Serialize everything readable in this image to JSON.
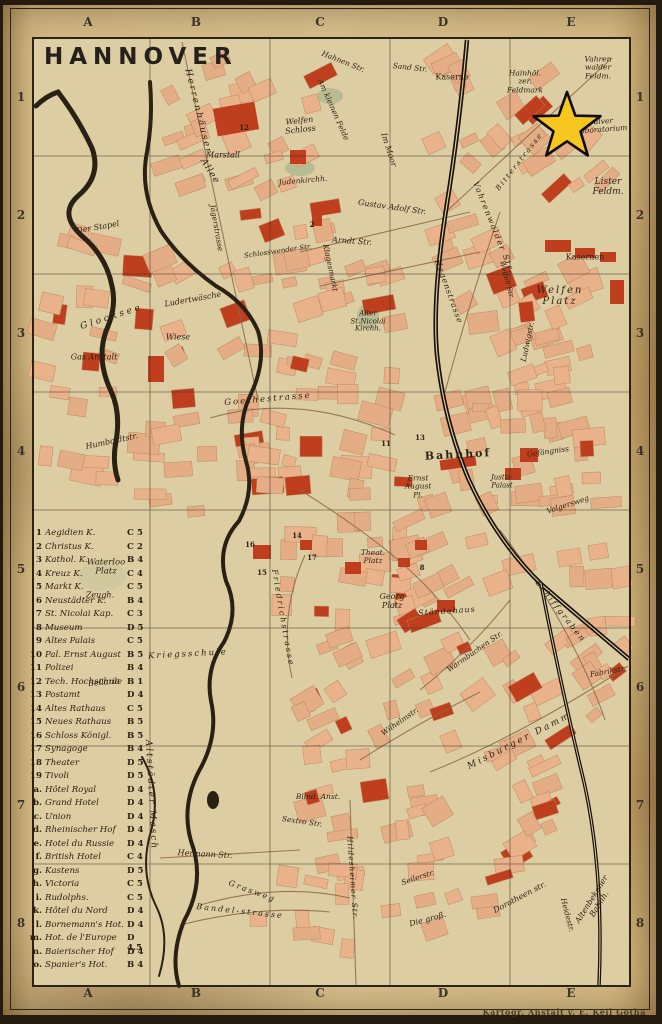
{
  "title": "HANNOVER",
  "attribution": "Kartogr. Anstalt v. E. Keil Gotha",
  "grid": {
    "columns": [
      "A",
      "B",
      "C",
      "D",
      "E"
    ],
    "rows": [
      "1",
      "2",
      "3",
      "4",
      "5",
      "6",
      "7",
      "8"
    ]
  },
  "star": {
    "meaning": "highlight-marker",
    "color": "#f7c71f",
    "near_label": "Pulver Laboratorium"
  },
  "colors": {
    "paper": "#d7bf8d",
    "map_paper": "#ddcda2",
    "block": "#e9b28b",
    "red": "#bf3e1d",
    "ink": "#2e2315",
    "water": "#2a2115",
    "rail": "#16100b",
    "star": "#f7c71f"
  },
  "legend": {
    "entries": [
      {
        "key": "1",
        "label": "Aegidien K.",
        "ref": "C 5"
      },
      {
        "key": "2",
        "label": "Christus K.",
        "ref": "C 2"
      },
      {
        "key": "3",
        "label": "Kathol. K.",
        "ref": "B 4"
      },
      {
        "key": "4",
        "label": "Kreuz K.",
        "ref": "C 4"
      },
      {
        "key": "5",
        "label": "Markt K.",
        "ref": "C 5"
      },
      {
        "key": "6",
        "label": "Neustädter K.",
        "ref": "B 4"
      },
      {
        "key": "7",
        "label": "St. Nicolai Kap.",
        "ref": "C 3"
      },
      {
        "key": "8",
        "label": "Museum",
        "ref": "D 5"
      },
      {
        "key": "9",
        "label": "Altes Palais",
        "ref": "C 5"
      },
      {
        "key": "10",
        "label": "Pal. Ernst August",
        "ref": "B 5"
      },
      {
        "key": "11",
        "label": "Polizei",
        "ref": "B 4"
      },
      {
        "key": "12",
        "label": "Tech. Hochschule",
        "ref": "B 1"
      },
      {
        "key": "13",
        "label": "Postamt",
        "ref": "D 4"
      },
      {
        "key": "14",
        "label": "Altes Rathaus",
        "ref": "C 5"
      },
      {
        "key": "15",
        "label": "Neues Rathaus",
        "ref": "B 5"
      },
      {
        "key": "16",
        "label": "Schloss Königl.",
        "ref": "B 5"
      },
      {
        "key": "17",
        "label": "Synagoge",
        "ref": "B 4"
      },
      {
        "key": "18",
        "label": "Theater",
        "ref": "D 5"
      },
      {
        "key": "19",
        "label": "Tivoli",
        "ref": "D 5"
      },
      {
        "key": "a.",
        "label": "Hôtel Royal",
        "ref": "D 4"
      },
      {
        "key": "b.",
        "label": "Grand Hotel",
        "ref": "D 4"
      },
      {
        "key": "c.",
        "label": "Union",
        "ref": "D 4"
      },
      {
        "key": "d.",
        "label": "Rheinischer Hof",
        "ref": "D 4"
      },
      {
        "key": "e.",
        "label": "Hotel du Russie",
        "ref": "D 4"
      },
      {
        "key": "f.",
        "label": "British Hotel",
        "ref": "C 4"
      },
      {
        "key": "g.",
        "label": "Kastens",
        "ref": "D 5"
      },
      {
        "key": "h.",
        "label": "Victoria",
        "ref": "C 5"
      },
      {
        "key": "i.",
        "label": "Rudolphs.",
        "ref": "C 5"
      },
      {
        "key": "k.",
        "label": "Hôtel du Nord",
        "ref": "D 4"
      },
      {
        "key": "l.",
        "label": "Bornemann's Hot.",
        "ref": "D 4"
      },
      {
        "key": "m.",
        "label": "Hot. de l'Europe",
        "ref": "D 4.5"
      },
      {
        "key": "n.",
        "label": "Baierischer Hof",
        "ref": "D 4"
      },
      {
        "key": "o.",
        "label": "Spanier's Hot.",
        "ref": "B 4"
      }
    ]
  },
  "map_labels": [
    {
      "t": "Herrenhäuser",
      "x": 197,
      "y": 112,
      "r": 76,
      "s": 9,
      "ls": 2
    },
    {
      "t": "Allee",
      "x": 209,
      "y": 172,
      "r": 58,
      "s": 9,
      "ls": 1
    },
    {
      "t": "Jägerstrasse",
      "x": 216,
      "y": 228,
      "r": 80,
      "s": 7.5
    },
    {
      "t": "Welfen\nSchloss",
      "x": 300,
      "y": 126,
      "r": -6,
      "s": 8
    },
    {
      "t": "Marstall",
      "x": 223,
      "y": 156,
      "r": 0,
      "s": 8
    },
    {
      "t": "Judenkirchh.",
      "x": 303,
      "y": 181,
      "r": -5,
      "s": 7.5
    },
    {
      "t": "Im Moor",
      "x": 388,
      "y": 150,
      "r": 72,
      "s": 8
    },
    {
      "t": "Am kleinen Felde",
      "x": 333,
      "y": 110,
      "r": 66,
      "s": 7.5
    },
    {
      "t": "Hahnen Str.",
      "x": 343,
      "y": 62,
      "r": 22,
      "s": 7.5
    },
    {
      "t": "Sand Str.",
      "x": 410,
      "y": 68,
      "r": 6,
      "s": 7.5
    },
    {
      "t": "Kaserne",
      "x": 452,
      "y": 78,
      "r": 0,
      "s": 8,
      "c": "rm"
    },
    {
      "t": "Hainhöl.\nzer.\nFeldmark",
      "x": 525,
      "y": 82,
      "r": 0,
      "s": 7.5
    },
    {
      "t": "Vahren\nwalder\nFeldm.",
      "x": 598,
      "y": 68,
      "r": 0,
      "s": 7.5
    },
    {
      "t": "Pulver\nLaboratorium",
      "x": 601,
      "y": 126,
      "r": -4,
      "s": 7.5
    },
    {
      "t": "Lister\nFeldm.",
      "x": 608,
      "y": 188,
      "r": 0,
      "s": 9
    },
    {
      "t": "Bitterstrasse",
      "x": 520,
      "y": 162,
      "r": -52,
      "s": 7,
      "ls": 2
    },
    {
      "t": "Vahrenwalder Str.",
      "x": 493,
      "y": 228,
      "r": 68,
      "s": 8,
      "ls": 1.5
    },
    {
      "t": "Gustav Adolf Str.",
      "x": 392,
      "y": 208,
      "r": 8,
      "s": 8
    },
    {
      "t": "Arndt Str.",
      "x": 352,
      "y": 242,
      "r": 4,
      "s": 8
    },
    {
      "t": "Klagesmarkt",
      "x": 330,
      "y": 268,
      "r": 78,
      "s": 7.5
    },
    {
      "t": "Schlosswender Str.",
      "x": 278,
      "y": 252,
      "r": -8,
      "s": 7
    },
    {
      "t": "Der Stapel",
      "x": 98,
      "y": 228,
      "r": -10,
      "s": 8
    },
    {
      "t": "Glocksee",
      "x": 112,
      "y": 318,
      "r": -18,
      "s": 9,
      "ls": 3
    },
    {
      "t": "Ludertwäsche",
      "x": 193,
      "y": 300,
      "r": -10,
      "s": 8
    },
    {
      "t": "Wiese",
      "x": 178,
      "y": 338,
      "r": 0,
      "s": 8
    },
    {
      "t": "Gas Anstalt",
      "x": 94,
      "y": 358,
      "r": 0,
      "s": 8
    },
    {
      "t": "Hagenstrasse",
      "x": 448,
      "y": 292,
      "r": 70,
      "s": 8,
      "ls": 1
    },
    {
      "t": "Kasernen",
      "x": 585,
      "y": 258,
      "r": 0,
      "s": 8,
      "c": "rm"
    },
    {
      "t": "Welfen\nPlatz",
      "x": 560,
      "y": 296,
      "r": 0,
      "s": 10,
      "ls": 2
    },
    {
      "t": "Welfen Str.",
      "x": 506,
      "y": 280,
      "r": 75,
      "s": 7
    },
    {
      "t": "Ludwigstr.",
      "x": 528,
      "y": 342,
      "r": -78,
      "s": 7.5
    },
    {
      "t": "Alter\nSt.Nicolai\nKirchh.",
      "x": 368,
      "y": 322,
      "r": 0,
      "s": 7
    },
    {
      "t": "Goethestrasse",
      "x": 268,
      "y": 400,
      "r": -5,
      "s": 8.5,
      "ls": 2
    },
    {
      "t": "Humboldtstr.",
      "x": 112,
      "y": 442,
      "r": -12,
      "s": 8
    },
    {
      "t": "Bahnhof",
      "x": 458,
      "y": 455,
      "r": -3,
      "s": 11,
      "ls": 2,
      "c": "big"
    },
    {
      "t": "Ernst\nAugust\nPl.",
      "x": 418,
      "y": 487,
      "r": 0,
      "s": 7.5
    },
    {
      "t": "Justiz-\nPalast",
      "x": 502,
      "y": 482,
      "r": 0,
      "s": 7
    },
    {
      "t": "Gefängniss",
      "x": 548,
      "y": 452,
      "r": -8,
      "s": 7.5
    },
    {
      "t": "Volgersweg",
      "x": 568,
      "y": 505,
      "r": -18,
      "s": 7.5
    },
    {
      "t": "Theat.\nPlatz",
      "x": 373,
      "y": 557,
      "r": 0,
      "s": 7.5
    },
    {
      "t": "Georg\nPlatz",
      "x": 392,
      "y": 602,
      "r": 0,
      "s": 8
    },
    {
      "t": "Ständehaus",
      "x": 447,
      "y": 612,
      "r": -4,
      "s": 8,
      "ls": 1
    },
    {
      "t": "Warmbüchen Str.",
      "x": 475,
      "y": 652,
      "r": -35,
      "s": 7.5
    },
    {
      "t": "Schiffgraben",
      "x": 560,
      "y": 612,
      "r": 52,
      "s": 8,
      "ls": 2
    },
    {
      "t": "Fabrikstr.",
      "x": 608,
      "y": 672,
      "r": -10,
      "s": 7.5
    },
    {
      "t": "Waterloo\nPlatz",
      "x": 106,
      "y": 568,
      "r": 0,
      "s": 8.5
    },
    {
      "t": "Zeugh.",
      "x": 100,
      "y": 596,
      "r": 0,
      "s": 8
    },
    {
      "t": "Kriegsschule",
      "x": 188,
      "y": 655,
      "r": -3,
      "s": 8.5,
      "ls": 2
    },
    {
      "t": "Bellaria",
      "x": 104,
      "y": 683,
      "r": -5,
      "s": 8
    },
    {
      "t": "Friedrichstrasse",
      "x": 282,
      "y": 618,
      "r": 80,
      "s": 8,
      "ls": 2
    },
    {
      "t": "Altstädter Masch",
      "x": 150,
      "y": 795,
      "r": 87,
      "s": 9,
      "ls": 2
    },
    {
      "t": "Hermann Str.",
      "x": 205,
      "y": 855,
      "r": 3,
      "s": 8
    },
    {
      "t": "Grasweg",
      "x": 252,
      "y": 892,
      "r": 20,
      "s": 8,
      "ls": 2
    },
    {
      "t": "Sextro Str.",
      "x": 302,
      "y": 822,
      "r": 8,
      "s": 7.5
    },
    {
      "t": "Blind. Anst.",
      "x": 318,
      "y": 797,
      "r": 0,
      "s": 7.5
    },
    {
      "t": "Wilhelmstr.",
      "x": 400,
      "y": 722,
      "r": -35,
      "s": 7.5
    },
    {
      "t": "Misburger Damm",
      "x": 520,
      "y": 742,
      "r": -27,
      "s": 9,
      "ls": 2.5
    },
    {
      "t": "Seilerstr.",
      "x": 418,
      "y": 878,
      "r": -18,
      "s": 7.5
    },
    {
      "t": "Hildesheimer Str.",
      "x": 352,
      "y": 878,
      "r": 86,
      "s": 7.5,
      "ls": 1
    },
    {
      "t": "Bandel-strasse",
      "x": 240,
      "y": 912,
      "r": 6,
      "s": 8,
      "ls": 2
    },
    {
      "t": "Die groß.",
      "x": 428,
      "y": 920,
      "r": -15,
      "s": 8
    },
    {
      "t": "Dorotheen str.",
      "x": 520,
      "y": 898,
      "r": -28,
      "s": 8
    },
    {
      "t": "Heidestr.",
      "x": 567,
      "y": 915,
      "r": 75,
      "s": 7.5
    },
    {
      "t": "Altenbekener Bahnh.",
      "x": 596,
      "y": 902,
      "r": -58,
      "s": 8
    },
    {
      "t": "12",
      "x": 244,
      "y": 128,
      "c": "num",
      "s": 7
    },
    {
      "t": "2",
      "x": 312,
      "y": 225,
      "c": "num",
      "s": 7
    },
    {
      "t": "13",
      "x": 420,
      "y": 438,
      "c": "num",
      "s": 7
    },
    {
      "t": "11",
      "x": 386,
      "y": 444,
      "c": "num",
      "s": 7
    },
    {
      "t": "14",
      "x": 297,
      "y": 536,
      "c": "num",
      "s": 7
    },
    {
      "t": "16",
      "x": 250,
      "y": 545,
      "c": "num",
      "s": 7
    },
    {
      "t": "15",
      "x": 262,
      "y": 573,
      "c": "num",
      "s": 7
    },
    {
      "t": "17",
      "x": 312,
      "y": 558,
      "c": "num",
      "s": 7
    },
    {
      "t": "8",
      "x": 422,
      "y": 568,
      "c": "num",
      "s": 7
    }
  ]
}
